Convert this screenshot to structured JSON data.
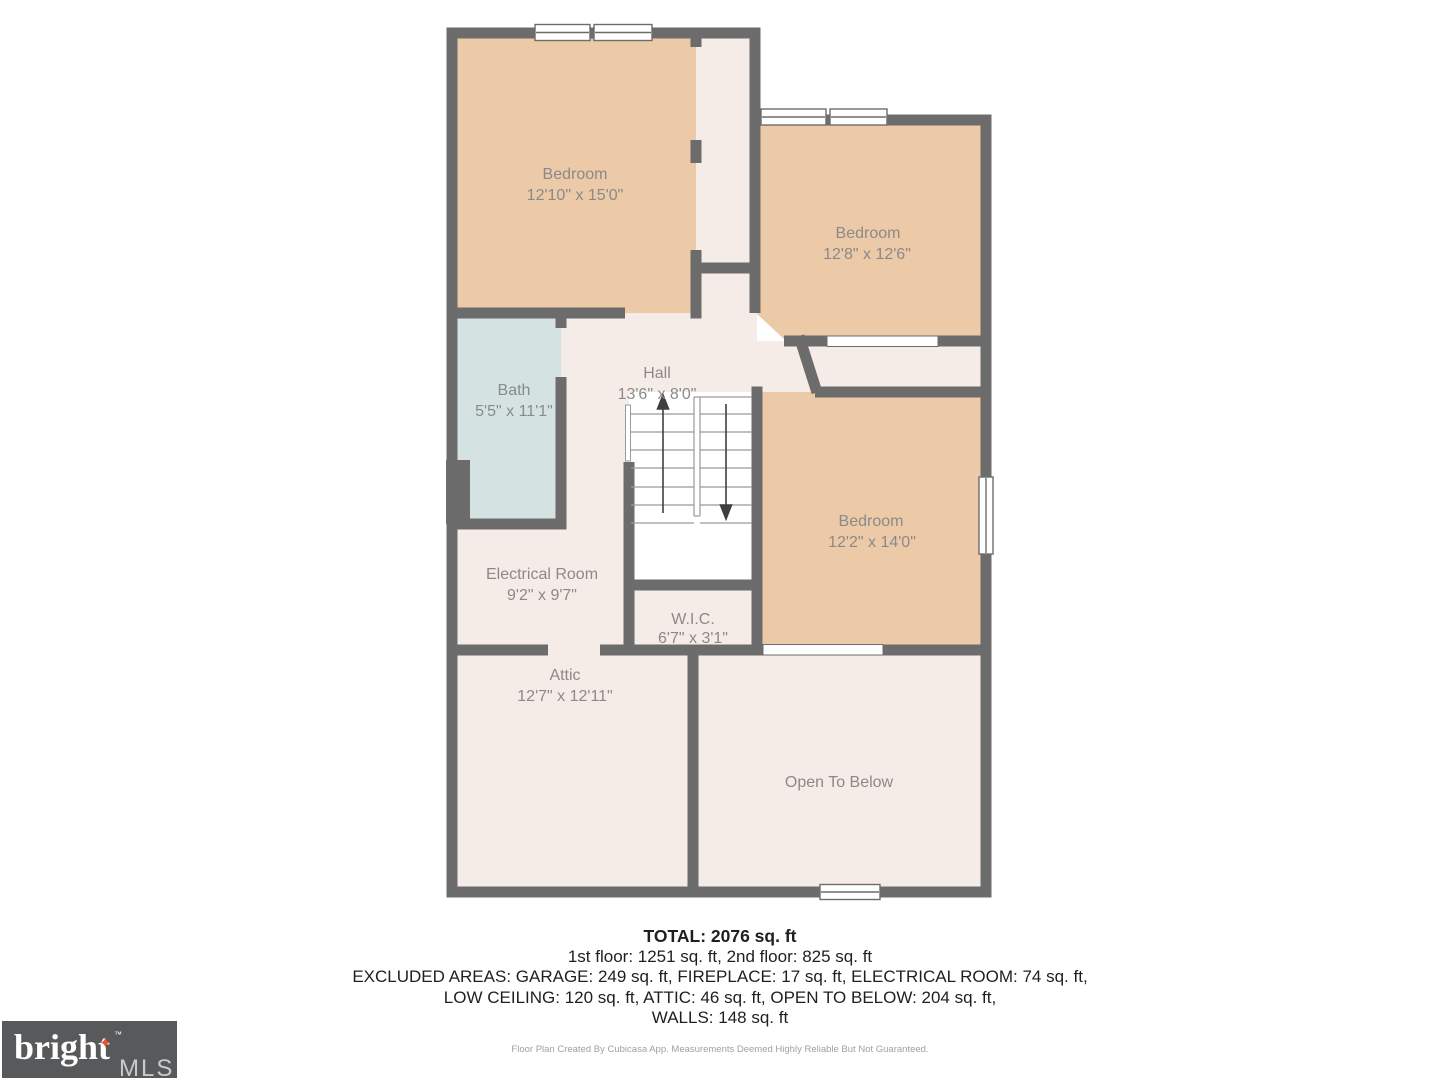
{
  "rooms": {
    "bedroom1": {
      "name": "Bedroom",
      "dims": "12'10\" x 15'0\""
    },
    "bedroom2": {
      "name": "Bedroom",
      "dims": "12'8\" x 12'6\""
    },
    "bedroom3": {
      "name": "Bedroom",
      "dims": "12'2\" x 14'0\""
    },
    "bath": {
      "name": "Bath",
      "dims": "5'5\" x 11'1\""
    },
    "hall": {
      "name": "Hall",
      "dims": "13'6\" x 8'0\""
    },
    "electrical": {
      "name": "Electrical Room",
      "dims": "9'2\" x 9'7\""
    },
    "wic": {
      "name": "W.I.C.",
      "dims": "6'7\" x 3'1\""
    },
    "attic": {
      "name": "Attic",
      "dims": "12'7\" x 12'11\""
    },
    "open_to_below": {
      "name": "Open To Below"
    }
  },
  "summary": {
    "total": "TOTAL: 2076 sq. ft",
    "floors": "1st floor: 1251 sq. ft, 2nd floor: 825 sq. ft",
    "excluded1": "EXCLUDED AREAS: GARAGE: 249 sq. ft, FIREPLACE: 17 sq. ft, ELECTRICAL ROOM: 74 sq. ft,",
    "excluded2": "LOW CEILING: 120 sq. ft, ATTIC: 46 sq. ft, OPEN TO BELOW: 204 sq. ft,",
    "walls": "WALLS: 148 sq. ft",
    "disclaimer": "Floor Plan Created By Cubicasa App. Measurements Deemed Highly Reliable But Not Guaranteed."
  },
  "logo": {
    "brand": "bright",
    "tm": "™",
    "suffix": "MLS",
    "star_icon": "sparkle-star",
    "star_color": "#e8532c"
  },
  "colors": {
    "wall": "#6c6c6c",
    "room_tan": "#ecc9a7",
    "floor_pink": "#f6ece7",
    "bath_blue": "#d4e2e2",
    "label_gray": "#8a8a8a"
  }
}
